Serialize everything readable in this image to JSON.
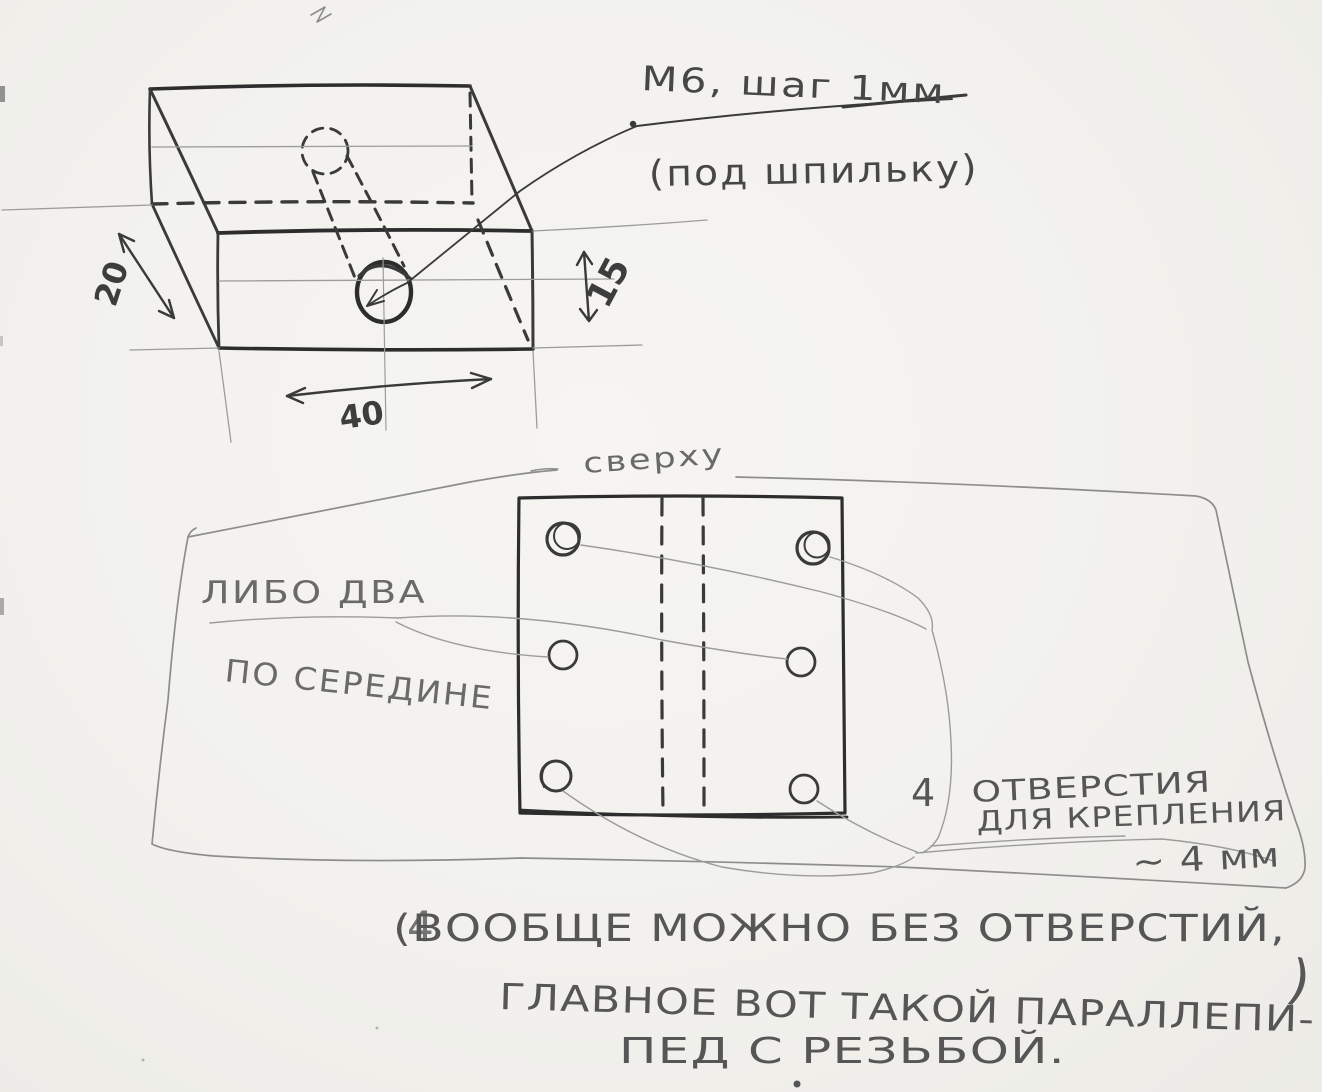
{
  "iso_view": {
    "thread_note_line1": "М6, шаг 1мм",
    "thread_note_line2": "(под шпильку)",
    "dim_depth": "20",
    "dim_height": "15",
    "dim_width": "40"
  },
  "top_view": {
    "view_label": "сверху",
    "alt_note_line1": "ЛИБО ДВА",
    "alt_note_line2": "ПО СЕРЕДИНЕ",
    "holes_count": "4",
    "holes_note_line1": "ОТВЕРСТИЯ",
    "holes_note_line2": "ДЛЯ КРЕПЛЕНИЯ",
    "holes_note_line3": "~ 4 мм"
  },
  "footnote": {
    "overwritten_char": "4",
    "line1": "(ВООБЩЕ МОЖНО БЕЗ ОТВЕРСТИЙ,",
    "closing_paren": ")",
    "line2": "ГЛАВНОЕ ВОТ ТАКОЙ ПАРАЛЛЕПИ-",
    "line3": "ПЕД С РЕЗЬБОЙ."
  },
  "colors": {
    "ink": "#3d3d3d",
    "pencil": "#8d8d8d",
    "paper": "#f2f1ed"
  }
}
